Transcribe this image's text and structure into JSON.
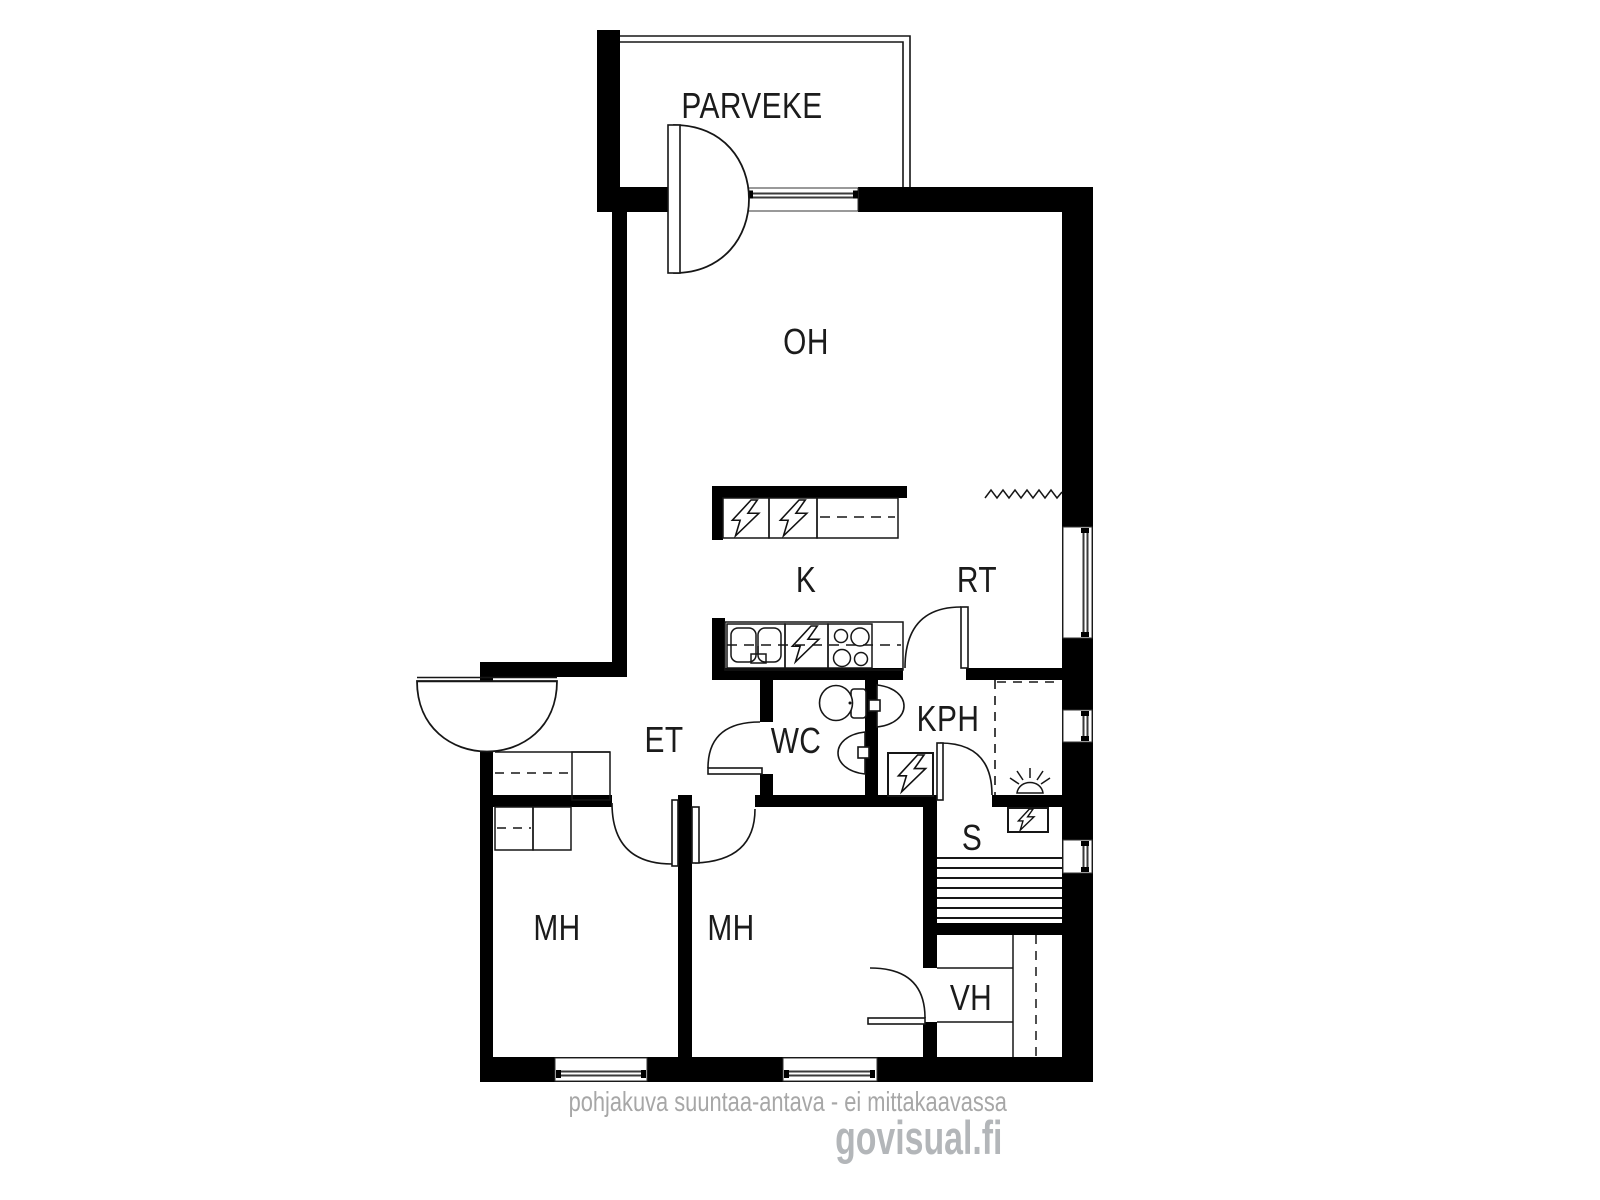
{
  "plan": {
    "title": "apartment-floor-plan",
    "rooms": [
      {
        "id": "parveke",
        "label": "PARVEKE"
      },
      {
        "id": "oh",
        "label": "OH"
      },
      {
        "id": "k",
        "label": "K"
      },
      {
        "id": "rt",
        "label": "RT"
      },
      {
        "id": "et",
        "label": "ET"
      },
      {
        "id": "wc",
        "label": "WC"
      },
      {
        "id": "kph",
        "label": "KPH"
      },
      {
        "id": "s",
        "label": "S"
      },
      {
        "id": "mh1",
        "label": "MH"
      },
      {
        "id": "mh2",
        "label": "MH"
      },
      {
        "id": "vh",
        "label": "VH"
      }
    ],
    "fixtures": [
      "refrigerator-bolt-icon",
      "freezer-bolt-icon",
      "kitchen-cabinet",
      "double-sink",
      "dishwasher-bolt-icon",
      "stove-4-burners",
      "toilet",
      "washbasin-wc",
      "washbasin-kph",
      "washing-machine-bolt-icon",
      "sauna-stove-bolt-icon",
      "floor-drain-icon",
      "sauna-benches",
      "radiator-zigzag-icon",
      "wardrobes",
      "entrance-door",
      "balcony-door"
    ],
    "colors": {
      "wall": "#000000",
      "line": "#161616",
      "glass": "#3a3a3a",
      "watermark": "#a7a7a7",
      "logo": "#b3b6b9",
      "background": "#ffffff"
    }
  },
  "footer": {
    "disclaimer": "pohjakuva suuntaa-antava - ei mittakaavassa",
    "brand": "govisual.fi"
  }
}
